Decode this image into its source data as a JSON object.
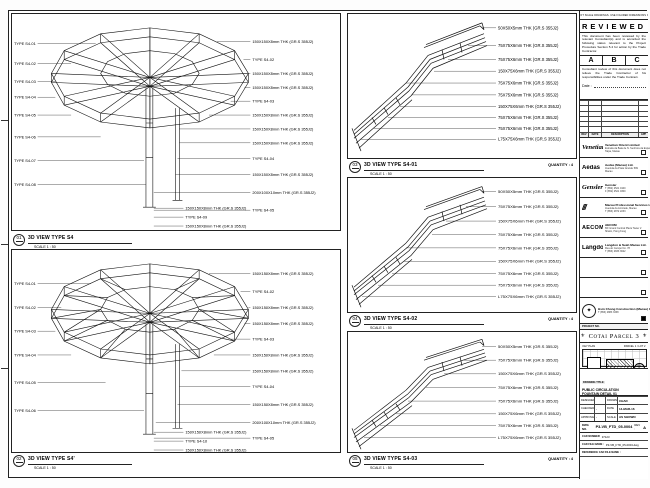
{
  "sheet": {
    "disclaimer": "DO NOT SCALE DRAWINGS. USE FIGURED DIMENSIONS ONLY."
  },
  "stamp": {
    "title": "REVIEWED",
    "body1": "This document has been reviewed by the relevant Consultant(s) and is accorded the following status relevant to the Project Procedure Section 5.4 for action by the Trade Contractor.",
    "grades": [
      "A",
      "B",
      "C"
    ],
    "body2": "Consultant review of this document does not relieve the Trade Contractor of his responsibilities under the Trade Contract.",
    "date_label": "Date :"
  },
  "revision_table": {
    "headers": [
      "REV",
      "DATE",
      "DESCRIPTION",
      "APP"
    ]
  },
  "consultants": [
    {
      "logo": "Venetian",
      "lc": "lg-script",
      "name": "Venetian Orient Limited",
      "line1": "Estrada da Baia de N. Senhora da Esperanca",
      "line2": "Taipa, Macau"
    },
    {
      "logo": "Aedas",
      "lc": "lg-sans",
      "name": "Aedas (Macau) Ltd.",
      "line1": "Avenida da Praia Grande 599",
      "line2": "Macau"
    },
    {
      "logo": "Gensler",
      "lc": "lg-script",
      "name": "Gensler",
      "line1": "T (852) 2521 0100",
      "line2": "F (852) 2521 0300"
    },
    {
      "logo": "///",
      "lc": "lg-slash",
      "name": "Macau Professional Services Ltd.",
      "line1": "Avenida da Amizade, Macau",
      "line2": "T (853) 2872 2233"
    },
    {
      "logo": "AECOM",
      "lc": "lg-caps",
      "name": "AECOM",
      "line1": "8/F Grand Central Plaza Tower 2",
      "line2": "Shatin, Hong Kong"
    },
    {
      "logo": "LangdonSeah",
      "lc": "lg-sans",
      "name": "Langdon & Seah Macau Ltd.",
      "line1": "Rua do Campo No. 78",
      "line2": "T (853) 2833 3622"
    },
    {
      "logo": "",
      "lc": "lg-sans",
      "name": "",
      "line1": "",
      "line2": ""
    },
    {
      "logo": "",
      "lc": "lg-sans",
      "name": "",
      "line1": "",
      "line2": ""
    }
  ],
  "contractor": {
    "name": "Hsin Chong Construction (Macau) Co. Ltd.",
    "line1": "T (853) 2883 3338",
    "emblem": "✦"
  },
  "project": {
    "no_label": "PROJECT NO.",
    "banner": "Cotai Parcel 3",
    "ornament": "⚜",
    "keyplan_label": "KEY PLAN",
    "keyplan_ref": "PARCEL 1 / LOT 2",
    "compass": "✛"
  },
  "titleblock": {
    "drawing_title_label": "DRAWING TITLE:",
    "title_line1": "PUBLIC CIRCULATION",
    "title_line2": "FOUNTAIN DETAIL 01",
    "title_line3": "FOR STEEL DRAWING",
    "designed_label": "DESIGNED",
    "designed": "",
    "drawn_label": "DRAWN",
    "drawn": "CHAD",
    "checked_label": "CHECKED",
    "checked": "-",
    "date_label": "DATE",
    "date": "14-MAR-16",
    "approved_label": "APPROVED",
    "approved": "-",
    "scale_label": "SCALE",
    "scale": "AS SHOWN",
    "dwg_label": "DWG NO.",
    "dwg_no": "P3-VB_FTD_05-0004",
    "rev_label": "REV :",
    "rev": "A",
    "cad_no_label": "CAD NUMBER",
    "cad_no": "37123",
    "cad_file_label": "CAD FILE NAME :",
    "cad_file": "P3-VB_FTD_05-0004.dwg",
    "ref_file_label": "REFERENCE CAD FILE NAME :",
    "ref_file": ""
  },
  "views": {
    "v1": {
      "num": "01",
      "title": "3D VIEW TYPE S4",
      "scale": "SCALE 1 : 50",
      "left": [
        "TYPE S4-01",
        "TYPE S4-02",
        "TYPE S4-03",
        "TYPE S4-04",
        "TYPE S4-05",
        "TYPE S4-06",
        "TYPE S4-07",
        "TYPE S4-08"
      ],
      "right": [
        "150X150X8mm THK (GR.S 355J2)",
        "TYPE S4-02",
        "150X150X8mm THK (GR.S 355J2)",
        "150X150X8mm THK (GR.S 355J2)",
        "TYPE S4-03",
        "150X150X8mm THK (GR.S 355J2)",
        "150X150X8mm THK (GR.S 355J2)",
        "150X150X8mm THK (GR.S 355J2)",
        "TYPE S4-04",
        "150X150X8mm THK (GR.S 355J2)",
        "200X100X10mm THK (GR.S 355J2)",
        "TYPE S4-05"
      ],
      "bottom": [
        "150X150X8mm THK (GR.S 355J2)",
        "TYPE S4-09",
        "150X150X8mm THK (GR.S 355J2)"
      ]
    },
    "v2": {
      "num": "02",
      "title": "3D VIEW TYPE S4'",
      "scale": "SCALE 1 : 50",
      "left": [
        "TYPE S4-01",
        "TYPE S4-02",
        "TYPE S4-03",
        "TYPE S4-04",
        "TYPE S4-05",
        "TYPE S4-06"
      ],
      "right": [
        "150X150X8mm THK (GR.S 355J2)",
        "TYPE S4-02",
        "150X150X8mm THK (GR.S 355J2)",
        "150X150X8mm THK (GR.S 355J2)",
        "TYPE S4-03",
        "150X150X8mm THK (GR.S 355J2)",
        "150X150X8mm THK (GR.S 355J2)",
        "TYPE S4-04",
        "150X150X8mm THK (GR.S 355J2)",
        "200X100X10mm THK (GR.S 355J2)",
        "TYPE S4-05"
      ],
      "bottom": [
        "150X150X8mm THK (GR.S 355J2)",
        "TYPE S4-10",
        "150X150X8mm THK (GR.S 355J2)"
      ]
    },
    "v3": {
      "num": "03",
      "title": "3D VIEW TYPE S4-01",
      "scale": "SCALE 1 : 50",
      "qty": "QUANTITY : 4",
      "right": [
        "50X50X5mm THK (GR.S 355J2)",
        "75X75X6mm THK (GR.S 355J2)",
        "75X75X6mm THK (GR.S 355J2)",
        "150X75X6mm THK (GR.S 355J2)",
        "75X75X6mm THK (GR.S 355J2)",
        "75X75X6mm THK (GR.S 355J2)",
        "150X75X6mm THK (GR.S 355J2)",
        "75X75X6mm THK (GR.S 355J2)",
        "75X75X6mm THK (GR.S 355J2)",
        "L75X75X6mm THK (GR.S 355J2)"
      ]
    },
    "v4": {
      "num": "04",
      "title": "3D VIEW TYPE S4-02",
      "scale": "SCALE 1 : 50",
      "qty": "QUANTITY : 4",
      "right": [
        "50X50X5mm THK (GR.S 355J2)",
        "75X75X6mm THK (GR.S 355J2)",
        "150X75X6mm THK (GR.S 355J2)",
        "75X75X6mm THK (GR.S 355J2)",
        "75X75X6mm THK (GR.S 355J2)",
        "150X75X6mm THK (GR.S 355J2)",
        "75X75X6mm THK (GR.S 355J2)",
        "75X75X6mm THK (GR.S 355J2)",
        "L75X75X6mm THK (GR.S 355J2)"
      ]
    },
    "v5": {
      "num": "05",
      "title": "3D VIEW TYPE S4-03",
      "scale": "SCALE 1 : 50",
      "qty": "QUANTITY : 4",
      "right": [
        "50X50X5mm THK (GR.S 355J2)",
        "75X75X6mm THK (GR.S 355J2)",
        "150X75X6mm THK (GR.S 355J2)",
        "75X75X6mm THK (GR.S 355J2)",
        "75X75X6mm THK (GR.S 355J2)",
        "150X75X6mm THK (GR.S 355J2)",
        "75X75X6mm THK (GR.S 355J2)",
        "L75X75X6mm THK (GR.S 355J2)"
      ]
    }
  }
}
